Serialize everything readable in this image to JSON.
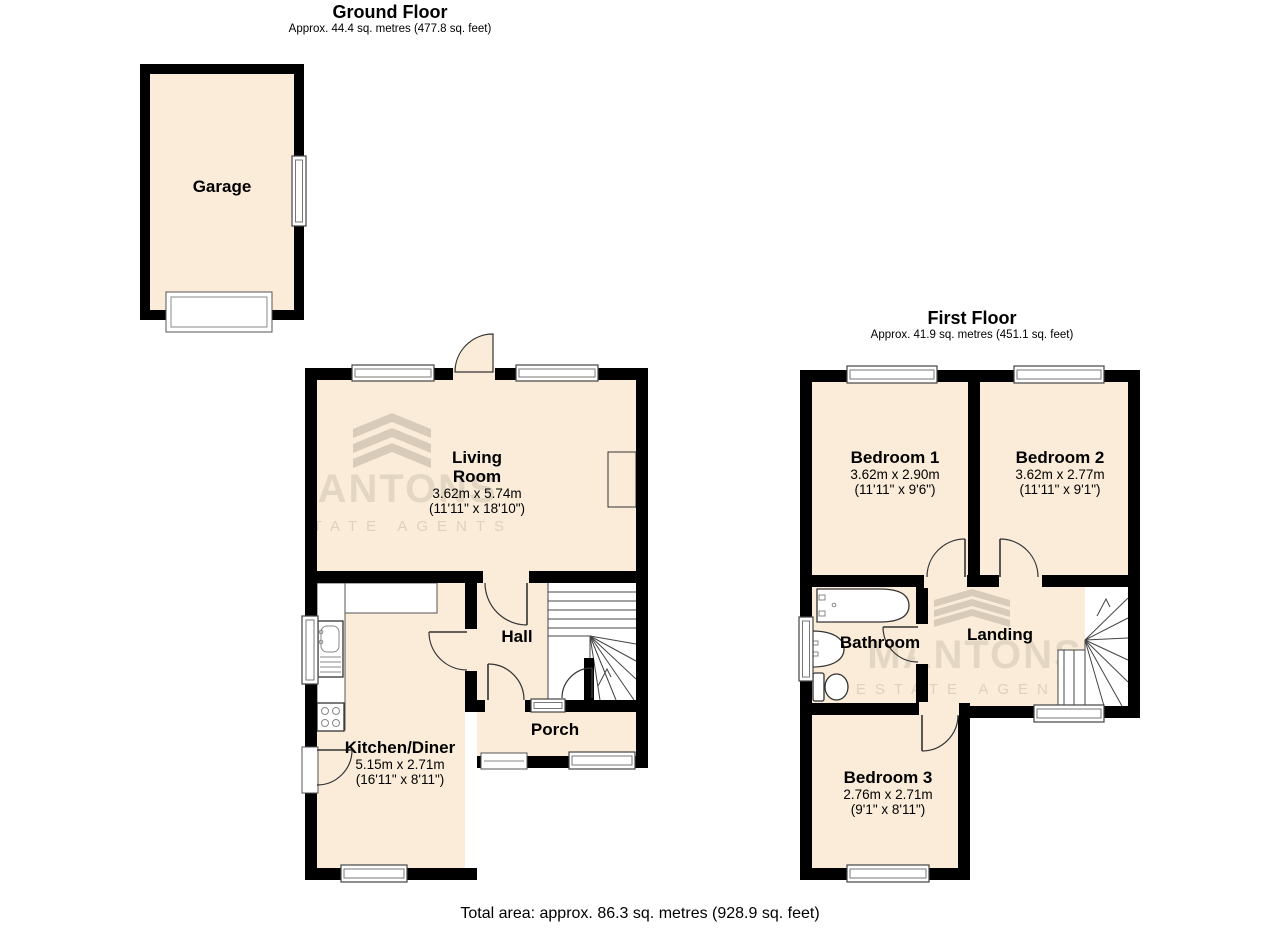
{
  "colors": {
    "room_fill": "#FAECD9",
    "wall": "#000000",
    "watermark": "#8D8070"
  },
  "ground_floor": {
    "title": "Ground Floor",
    "subtitle": "Approx. 44.4 sq. metres (477.8 sq. feet)",
    "rooms": {
      "garage": {
        "name": "Garage"
      },
      "living_room": {
        "name": "Living Room",
        "dimensions_m": "3.62m x 5.74m",
        "dimensions_ft": "(11'11\" x 18'10\")"
      },
      "hall": {
        "name": "Hall"
      },
      "porch": {
        "name": "Porch"
      },
      "kitchen_diner": {
        "name": "Kitchen/Diner",
        "dimensions_m": "5.15m x 2.71m",
        "dimensions_ft": "(16'11\" x 8'11\")"
      }
    }
  },
  "first_floor": {
    "title": "First Floor",
    "subtitle": "Approx. 41.9 sq. metres (451.1 sq. feet)",
    "rooms": {
      "bedroom_1": {
        "name": "Bedroom 1",
        "dimensions_m": "3.62m x 2.90m",
        "dimensions_ft": "(11'11\" x 9'6\")"
      },
      "bedroom_2": {
        "name": "Bedroom 2",
        "dimensions_m": "3.62m x 2.77m",
        "dimensions_ft": "(11'11\" x 9'1\")"
      },
      "bathroom": {
        "name": "Bathroom"
      },
      "landing": {
        "name": "Landing"
      },
      "bedroom_3": {
        "name": "Bedroom 3",
        "dimensions_m": "2.76m x 2.71m",
        "dimensions_ft": "(9'1\" x 8'11\")"
      }
    }
  },
  "footer": {
    "total_area": "Total area: approx. 86.3 sq. metres (928.9 sq. feet)"
  },
  "watermark": {
    "brand": "MANTONS",
    "tagline": "ESTATE AGENTS"
  }
}
